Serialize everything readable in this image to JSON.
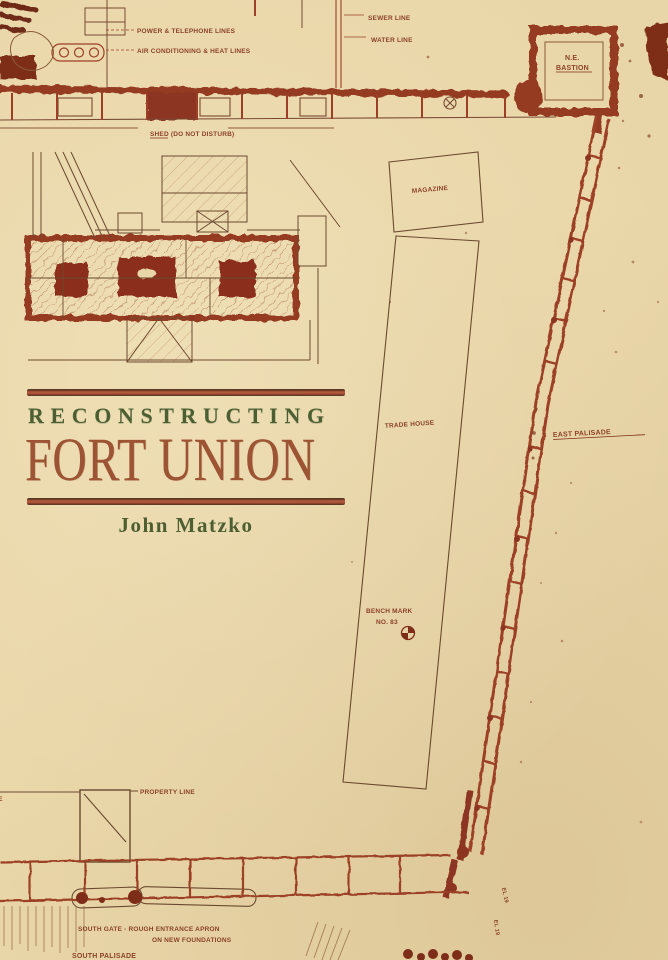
{
  "cover": {
    "title_line1": "RECONSTRUCTING",
    "title_line2": "FORT UNION",
    "author": "John Matzko"
  },
  "colors": {
    "background": "#e9d6a8",
    "ink_red": "#9c3f26",
    "ink_dark": "#7e2d18",
    "ink_thin": "#6b4a2f",
    "title_green": "#4b5f33",
    "title_red": "#9d5434",
    "rule_red": "#ad5338"
  },
  "plan_annotations": {
    "power_telephone_lines": "POWER & TELEPHONE LINES",
    "air_conditioning_heat_lines": "AIR CONDITIONING & HEAT LINES",
    "sewer_line": "SEWER LINE",
    "water_line": "WATER LINE",
    "ne_bastion_line1": "N.E.",
    "ne_bastion_line2": "BASTION",
    "shed_note": "SHED (DO NOT DISTURB)",
    "magazine": "MAGAZINE",
    "trade_house": "TRADE HOUSE",
    "east_palisade": "EAST PALISADE",
    "bench_mark_line1": "BENCH MARK",
    "bench_mark_line2": "NO. 83",
    "property_line": "PROPERTY LINE",
    "edge_fragment": "LINE",
    "south_note_line1": "SOUTH GATE - ROUGH ENTRANCE APRON",
    "south_note_line2": "ON NEW FOUNDATIONS",
    "south_palisade": "SOUTH PALISADE",
    "elevation_mark_1": "EL 19",
    "elevation_mark_2": "EL 19"
  }
}
